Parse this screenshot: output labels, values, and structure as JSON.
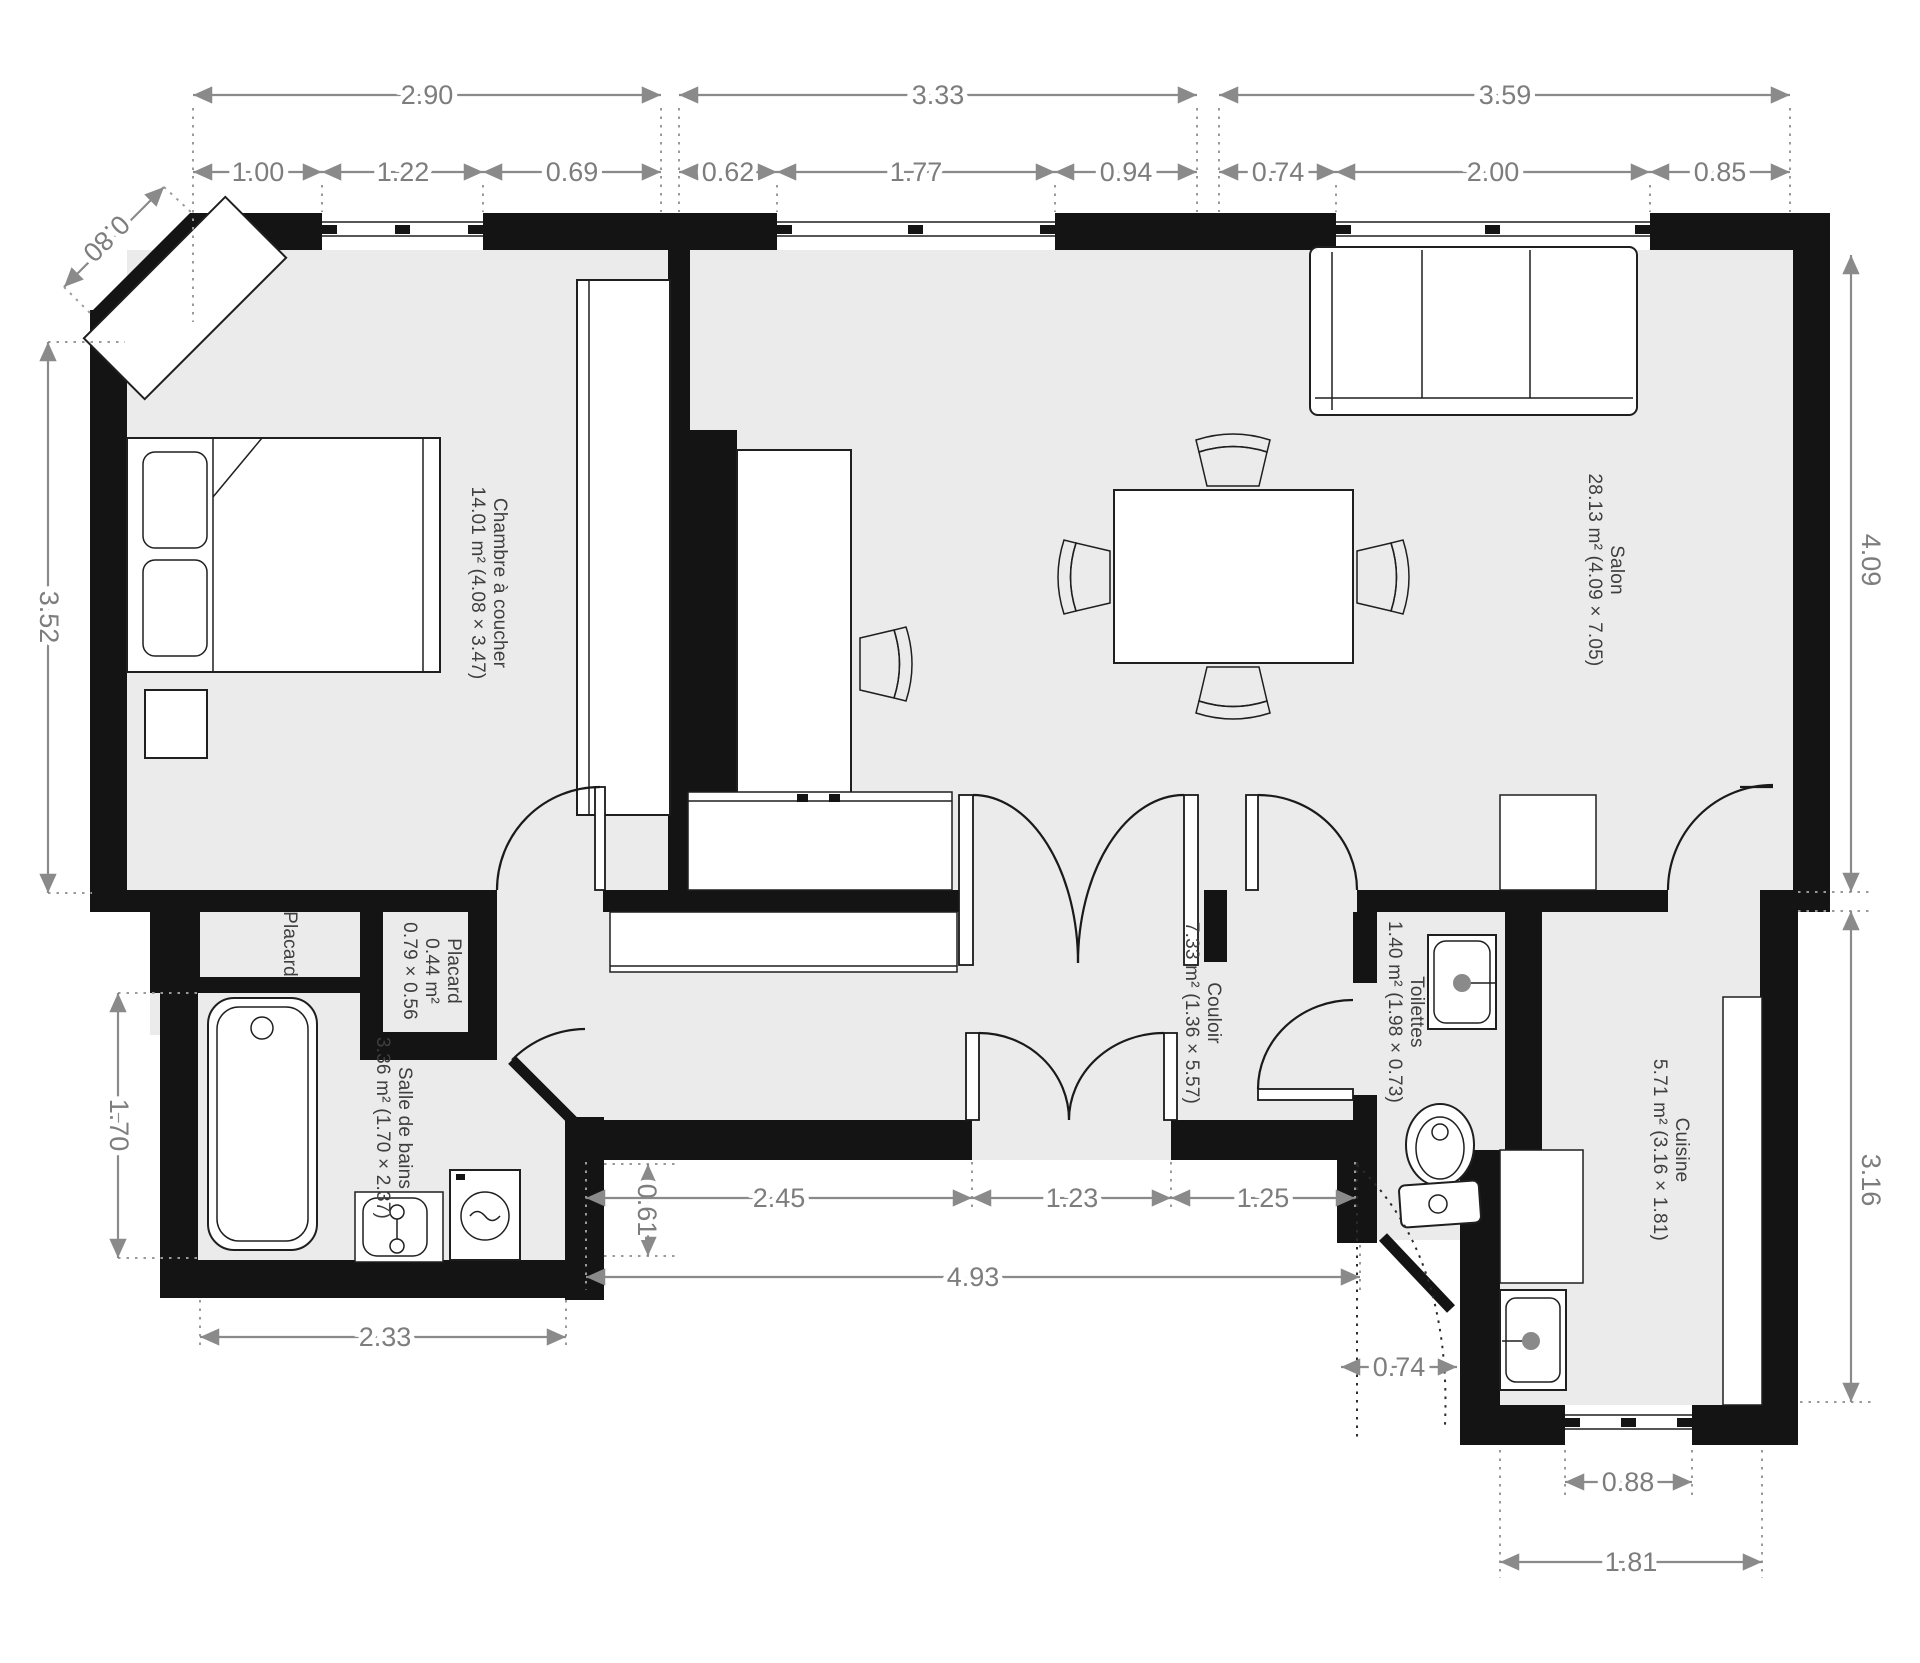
{
  "plan": {
    "rooms": {
      "chambre": {
        "name": "Chambre à coucher",
        "details": "14.01 m² (4.08 × 3.47)"
      },
      "salon": {
        "name": "Salon",
        "details": "28.13 m² (4.09 × 7.05)"
      },
      "placard_nord": {
        "name": "Placard"
      },
      "placard": {
        "name": "Placard",
        "area": "0.44 m²",
        "size": "0.79 × 0.56"
      },
      "salle_de_bains": {
        "name": "Salle de bains",
        "details": "3.36 m² (1.70 × 2.37)"
      },
      "couloir": {
        "name": "Couloir",
        "details": "7.33 m² (1.36 × 5.57)"
      },
      "toilettes": {
        "name": "Toilettes",
        "details": "1.40 m² (1.98 × 0.73)"
      },
      "cuisine": {
        "name": "Cuisine",
        "details": "5.71 m² (3.16 × 1.81)"
      }
    },
    "dimensions": {
      "top_overall": {
        "d1": "2.90",
        "d2": "3.33",
        "d3": "3.59"
      },
      "top_segments": {
        "s1": "1.00",
        "s2": "1.22",
        "s3": "0.69",
        "s4": "0.62",
        "s5": "1.77",
        "s6": "0.94",
        "s7": "0.74",
        "s8": "2.00",
        "s9": "0.85"
      },
      "left": {
        "diag": "0.80",
        "bedroom": "3.52",
        "bath": "1.70",
        "bath_width": "2.33"
      },
      "right": {
        "salon": "4.09",
        "kitchen": "3.16"
      },
      "bottom": {
        "jog": "0.61",
        "corridor": "2.45",
        "double_door": "1.23",
        "corridor_right": "1.25",
        "total": "4.93",
        "entry": "0.74",
        "kitchen_window": "0.88",
        "kitchen_width": "1.81"
      }
    },
    "colors": {
      "wall": "#141414",
      "floor": "#ebebeb",
      "dimension": "#8a8a8a",
      "label": "#3e3e3e"
    }
  }
}
